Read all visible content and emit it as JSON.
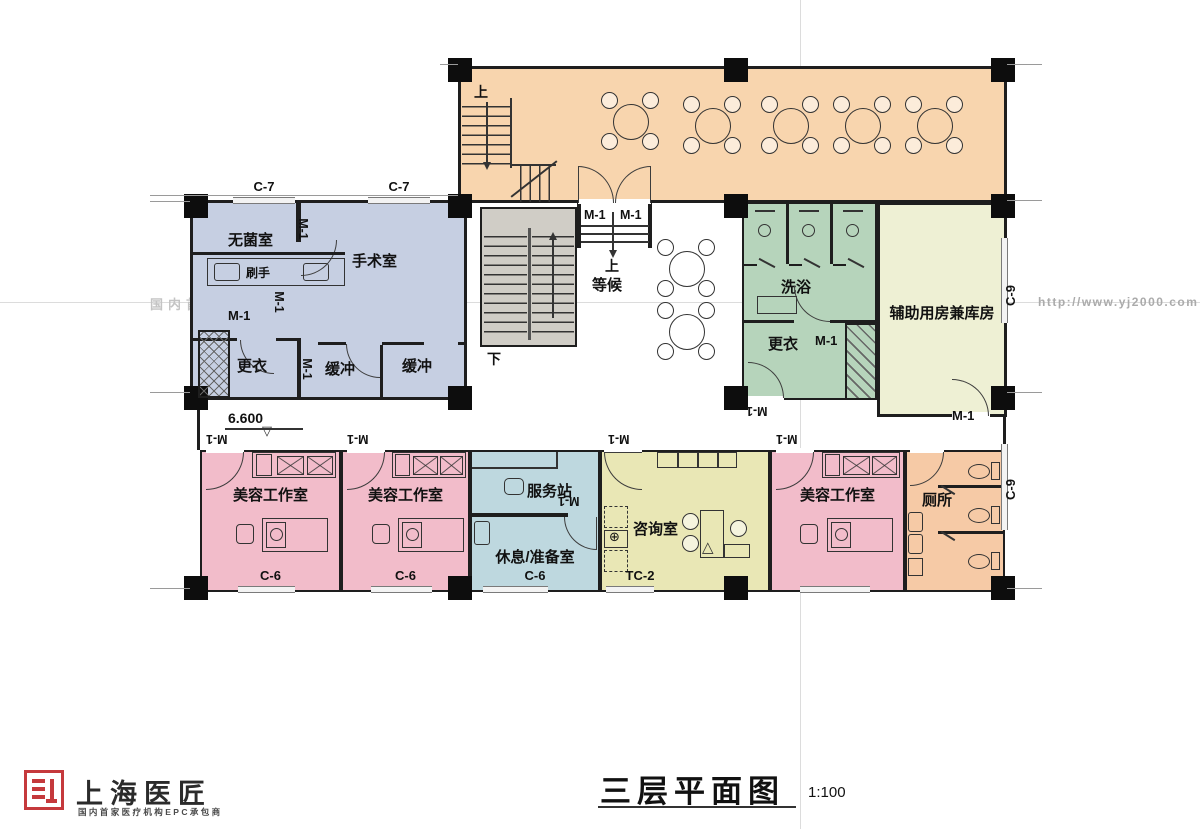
{
  "colors": {
    "dining": "#f8d5ae",
    "surgery": "#c6cfe2",
    "stairwell": "#d0cdc6",
    "bath": "#b6d4bb",
    "storage": "#eef0d4",
    "beauty": "#f2bcca",
    "service": "#bed8df",
    "consult": "#e9e7b5",
    "toilet": "#f6caa6",
    "wall": "#1e1e1e",
    "seal_red": "#c5393c"
  },
  "rooms": {
    "sterile": "无菌室",
    "operating": "手术室",
    "scrub": "刷手",
    "changing": "更衣",
    "buffer": "缓冲",
    "waiting": "等候",
    "bath": "洗浴",
    "aux_storage": "辅助用房兼库房",
    "beauty_studio": "美容工作室",
    "service_station": "服务站",
    "rest_prep": "休息/准备室",
    "consultation": "咨询室",
    "toilet": "厕所"
  },
  "tags": {
    "door_m1": "M-1",
    "win_c7": "C-7",
    "win_c6": "C-6",
    "win_c9": "C-9",
    "win_tc2": "TC-2"
  },
  "stairs": {
    "up": "上",
    "down": "下"
  },
  "level_marker": "6.600",
  "level_marker_symbol": "▽",
  "watermark": {
    "agency": "国内首家医疗机构EPC承包商",
    "url": "http://www.yj2000.com"
  },
  "titleblock": {
    "title": "三层平面图",
    "scale": "1:100"
  },
  "logo": {
    "name": "上海医匠",
    "tagline": "国内首家医疗机构EPC承包商"
  }
}
